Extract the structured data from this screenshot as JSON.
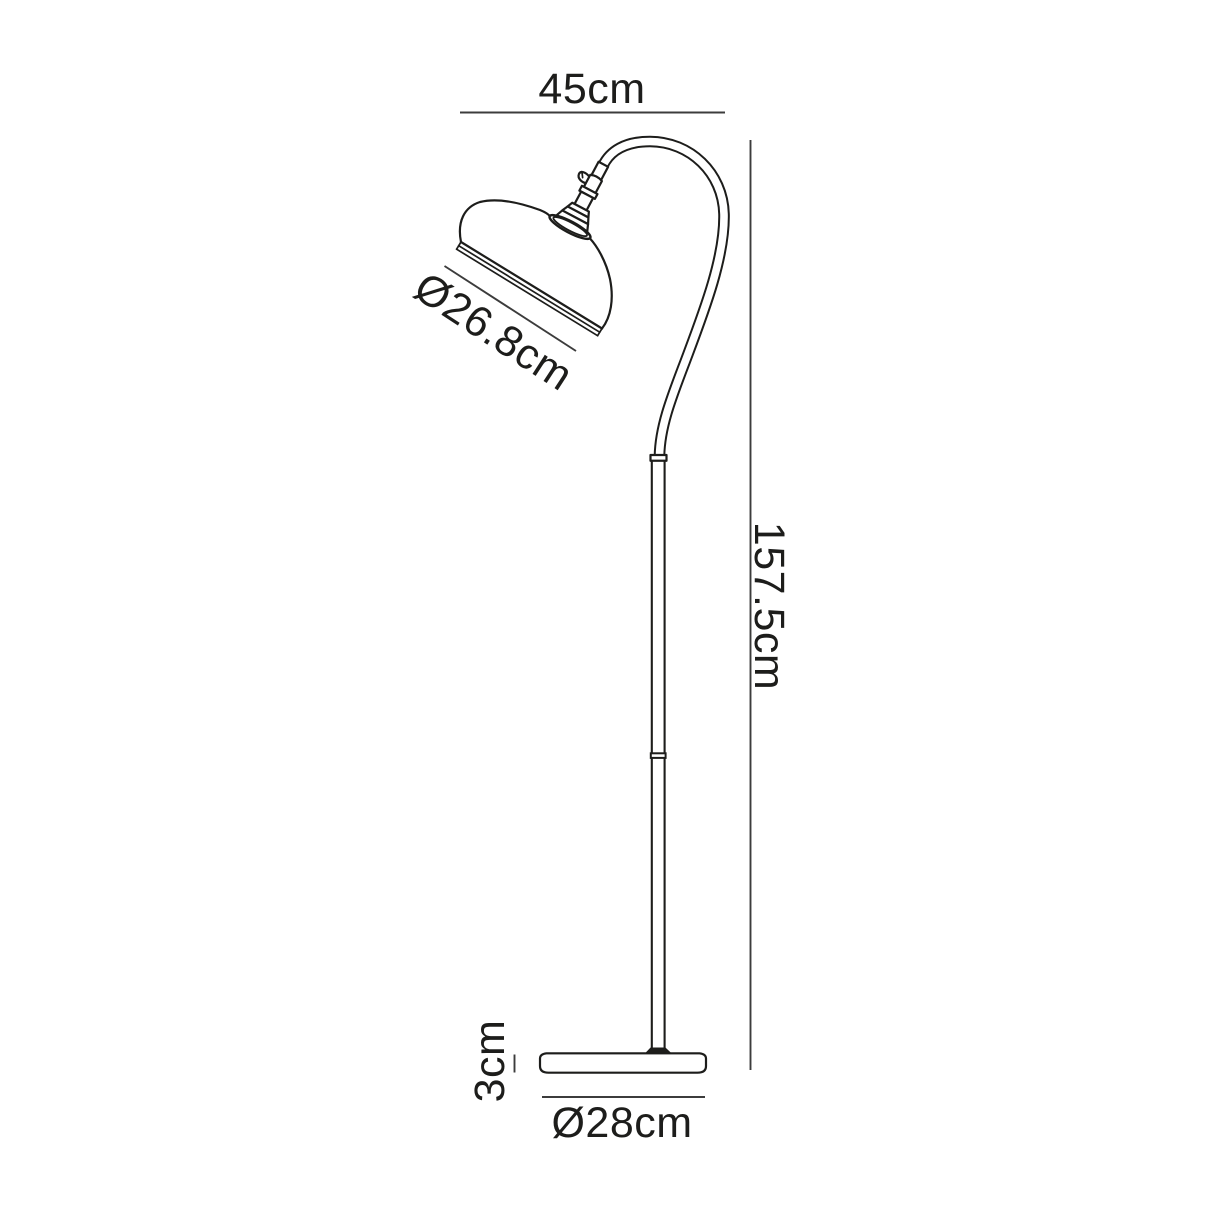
{
  "diagram": {
    "subject": "Arched floor lamp technical line drawing with dimensions",
    "style": {
      "background": "#ffffff",
      "line_color": "#1d1d1b",
      "dimension_line_color": "#3c3c3c"
    },
    "labels": {
      "arm_reach": "45cm",
      "shade_diameter": "Ø26.8cm",
      "total_height": "157.5cm",
      "base_height": "3cm",
      "base_diameter": "Ø28cm"
    }
  }
}
